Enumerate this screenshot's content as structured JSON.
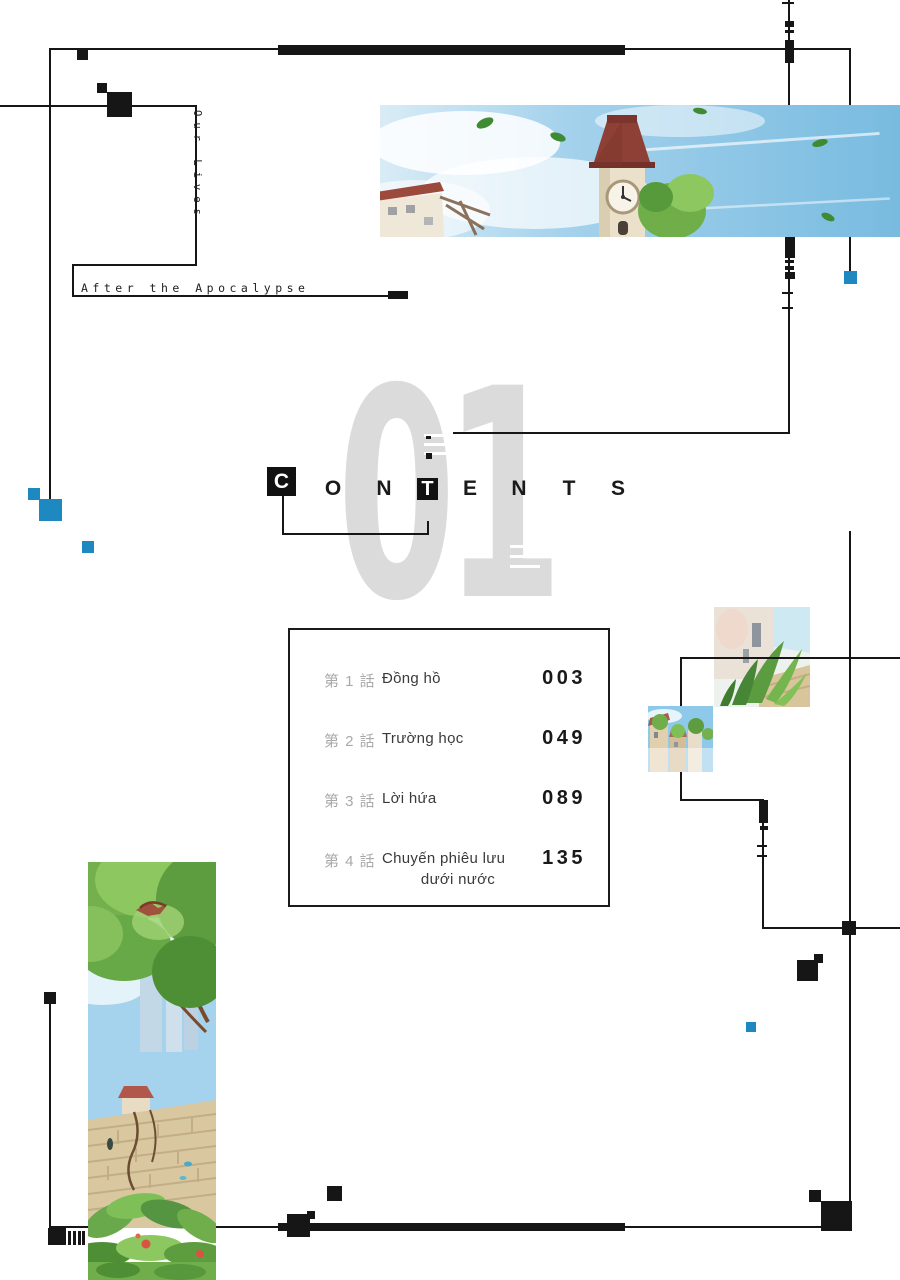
{
  "page": {
    "volume_number": "01"
  },
  "header": {
    "series_title_vertical": "Our Lives",
    "series_subtitle": "After the Apocalypse",
    "contents_letters": [
      "C",
      "O",
      "N",
      "T",
      "E",
      "N",
      "T",
      "S"
    ]
  },
  "contents": {
    "chapters": [
      {
        "label": "第 1 話",
        "title": "Đồng hồ",
        "title_line2": "",
        "page": "003"
      },
      {
        "label": "第 2 話",
        "title": "Trường học",
        "title_line2": "",
        "page": "049"
      },
      {
        "label": "第 3 話",
        "title": "Lời hứa",
        "title_line2": "",
        "page": "089"
      },
      {
        "label": "第 4 話",
        "title": "Chuyến phiêu lưu",
        "title_line2": "dưới nước",
        "page": "135"
      }
    ]
  },
  "images": {
    "banner": "watercolor clock tower with red roof under blue sky, drifting leaves",
    "left_tall": "watercolor tree over ruined brick wall, flying bird, red flowers",
    "thumb_plants": "watercolor green plants beside pale wall",
    "thumb_town": "watercolor town buildings with green trees"
  },
  "colors": {
    "accent_blue": "#1e88c0",
    "line_black": "#161616",
    "numeral_gray": "#dbdbdb",
    "chapter_label_gray": "#a9a9a9",
    "chapter_title_dark": "#3a3a3a"
  }
}
